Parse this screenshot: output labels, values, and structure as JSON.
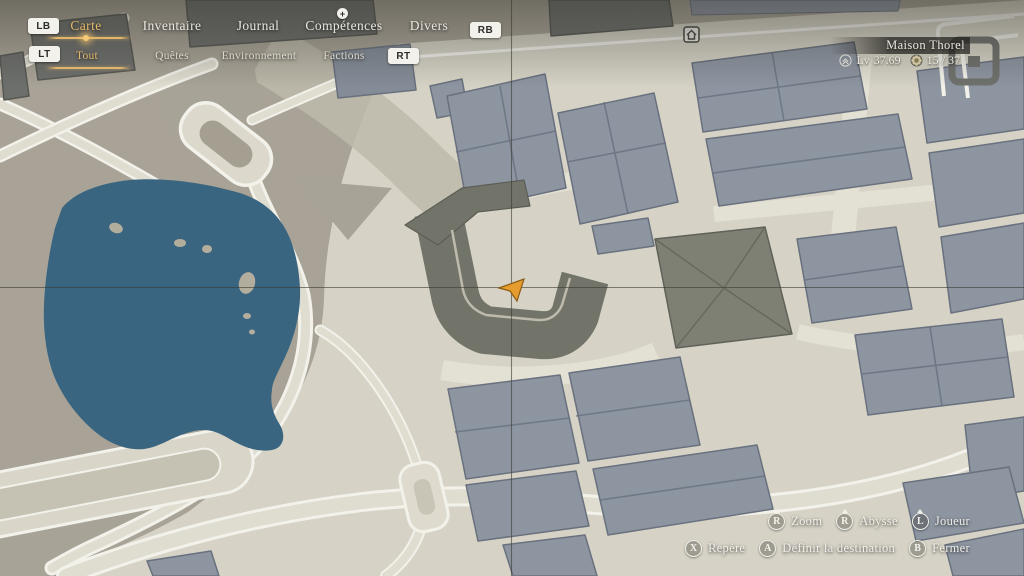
{
  "nav": {
    "lb_label": "LB",
    "rb_label": "RB",
    "lt_label": "LT",
    "rt_label": "RT",
    "tabs": [
      {
        "label": "Carte",
        "selected": true
      },
      {
        "label": "Inventaire",
        "selected": false
      },
      {
        "label": "Journal",
        "selected": false
      },
      {
        "label": "Compétences",
        "selected": false,
        "badge": "+"
      },
      {
        "label": "Divers",
        "selected": false
      }
    ],
    "filters": [
      {
        "label": "Tout",
        "selected": true
      },
      {
        "label": "Quêtes",
        "selected": false
      },
      {
        "label": "Environnement",
        "selected": false
      },
      {
        "label": "Factions",
        "selected": false
      }
    ]
  },
  "location_panel": {
    "name": "Maison Thorel",
    "level_prefix": "Lv",
    "level_value": "37.69",
    "flag_count": "15 / 37"
  },
  "controls": {
    "row1": [
      {
        "button": "R",
        "label": "Zoom",
        "stick": true
      },
      {
        "button": "R",
        "label": "Abysse",
        "stick": true
      },
      {
        "button": "L",
        "label": "Joueur",
        "stick": true
      }
    ],
    "row2": [
      {
        "button": "X",
        "label": "Repère",
        "stick": false
      },
      {
        "button": "A",
        "label": "Définir la destination",
        "stick": false
      },
      {
        "button": "B",
        "label": "Fermer",
        "stick": false
      }
    ]
  },
  "map": {
    "markers": {
      "player": "player-arrow",
      "poi": "house-poi"
    },
    "colors": {
      "water": "#3a6580",
      "ground_olive": "#a8a396",
      "ground_light": "#d6d3c6",
      "road_fill": "#dfdcd0",
      "road_edge": "#f2f1ea",
      "building_slate": "#8d95a1",
      "building_olive": "#72746a",
      "building_dark": "#6e706c",
      "player_arrow": "#e59b2e",
      "accent_gold": "#e5b96d"
    }
  }
}
